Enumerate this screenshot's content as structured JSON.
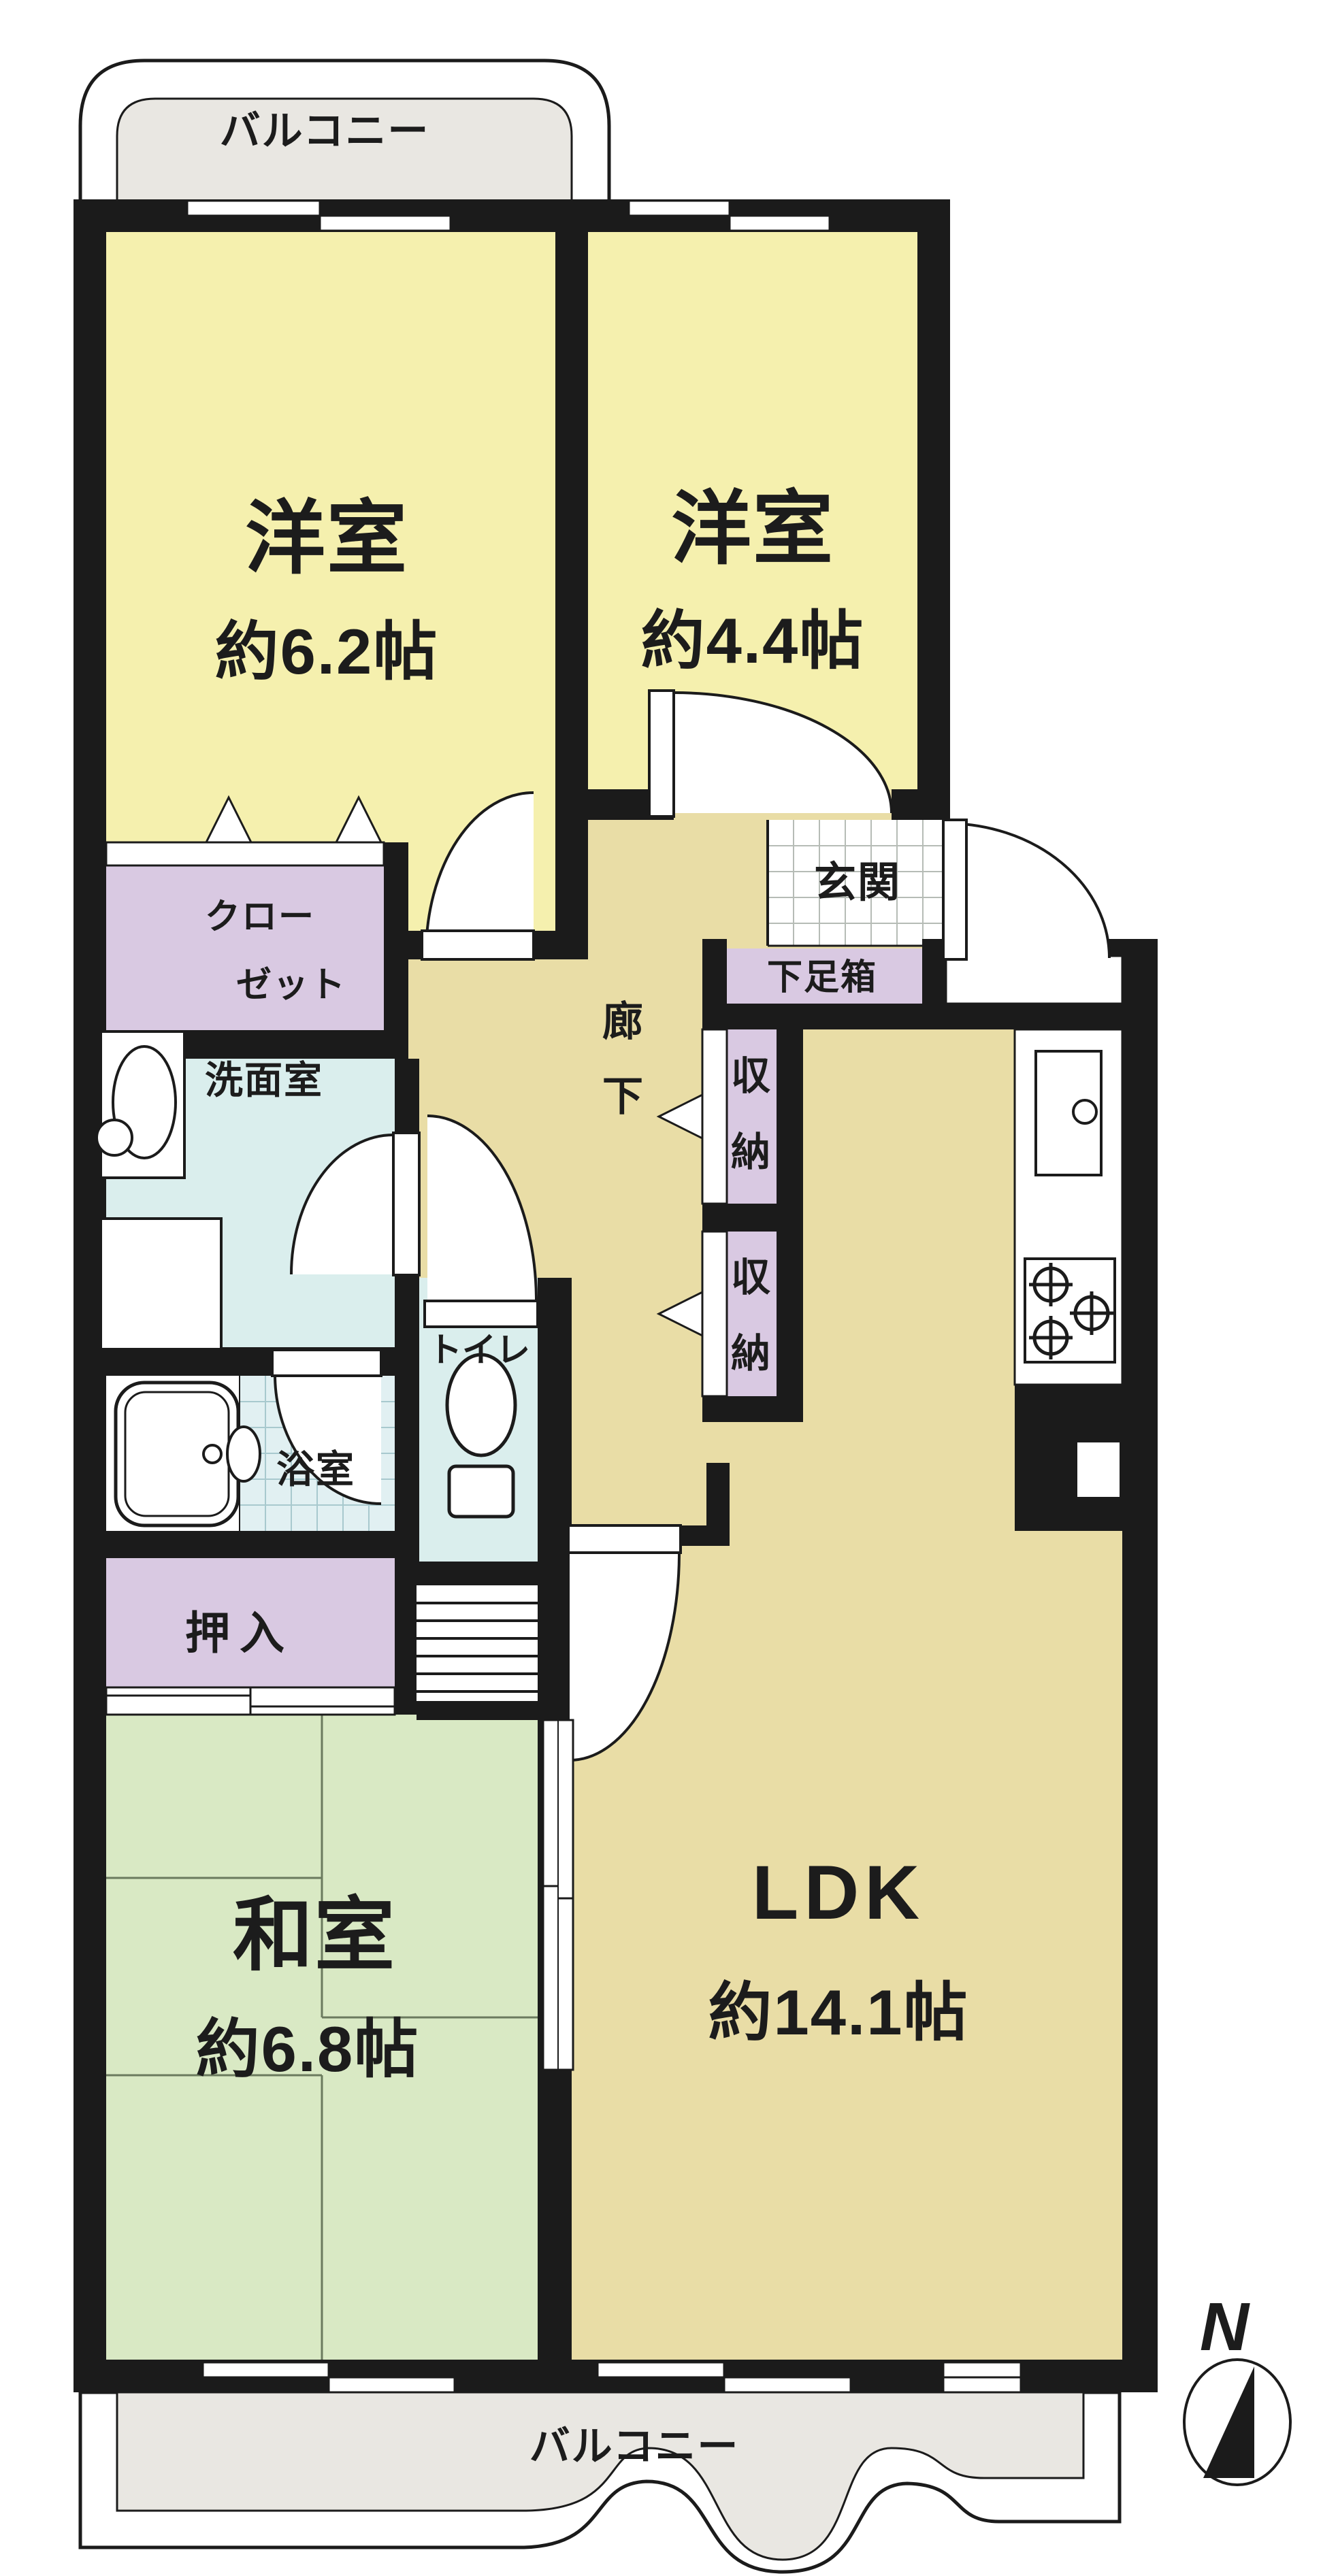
{
  "balcony_top": {
    "label": "バルコニー"
  },
  "balcony_bottom": {
    "label": "バルコニー"
  },
  "rooms": {
    "western1": {
      "name": "洋室",
      "area": "約6.2帖"
    },
    "western2": {
      "name": "洋室",
      "area": "約4.4帖"
    },
    "entrance": {
      "label": "玄関"
    },
    "shoebox": {
      "label": "下足箱"
    },
    "closet": {
      "line1": "クロー",
      "line2": "ゼット"
    },
    "washroom": {
      "label": "洗面室"
    },
    "corridor": {
      "char1": "廊",
      "char2": "下"
    },
    "storage1": {
      "char1": "収",
      "char2": "納"
    },
    "storage2": {
      "char1": "収",
      "char2": "納"
    },
    "toilet": {
      "label": "トイレ"
    },
    "bath": {
      "label": "浴室"
    },
    "oshiire": {
      "label": "押入"
    },
    "japanese": {
      "name": "和室",
      "area": "約6.8帖"
    },
    "ldk": {
      "name": "LDK",
      "area": "約14.1帖"
    }
  },
  "compass": {
    "label": "N"
  },
  "colors": {
    "wall": "#1b1b1b",
    "western_room": "#f5f0ae",
    "corridor_ldk": "#e9dda6",
    "tatami_room": "#d9e9c4",
    "storage": "#d9c9e2",
    "sanitary": "#daeeed",
    "bath_tile": "#e1f0f2",
    "balcony": "#e9e7e2"
  }
}
